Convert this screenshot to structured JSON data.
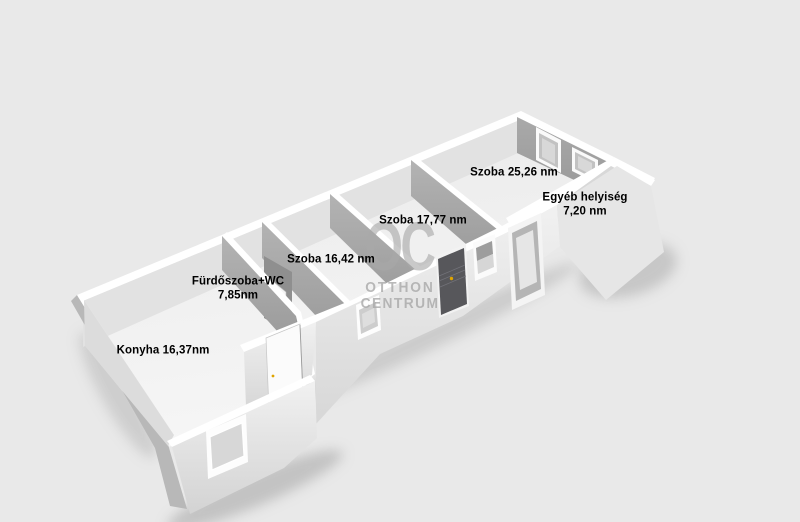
{
  "view": {
    "type": "3d-floorplan-render"
  },
  "watermark": {
    "logo": "OC",
    "name_line1": "OTTHON",
    "name_line2": "CENTRUM"
  },
  "rooms": [
    {
      "line1": "Konyha 16,37nm",
      "line2": ""
    },
    {
      "line1": "Fürdőszoba+WC",
      "line2": "7,85nm"
    },
    {
      "line1": "Szoba 16,42 nm",
      "line2": ""
    },
    {
      "line1": "Szoba 17,77 nm",
      "line2": ""
    },
    {
      "line1": "Szoba 25,26 nm",
      "line2": ""
    },
    {
      "line1": "Egyéb helyiség",
      "line2": "7,20 nm"
    }
  ],
  "colors": {
    "background": "#e9e9e9",
    "entry_door": "#57575b",
    "door_handle": "#dfa400",
    "watermark": "#a9a9a9",
    "label_text": "#000000"
  }
}
